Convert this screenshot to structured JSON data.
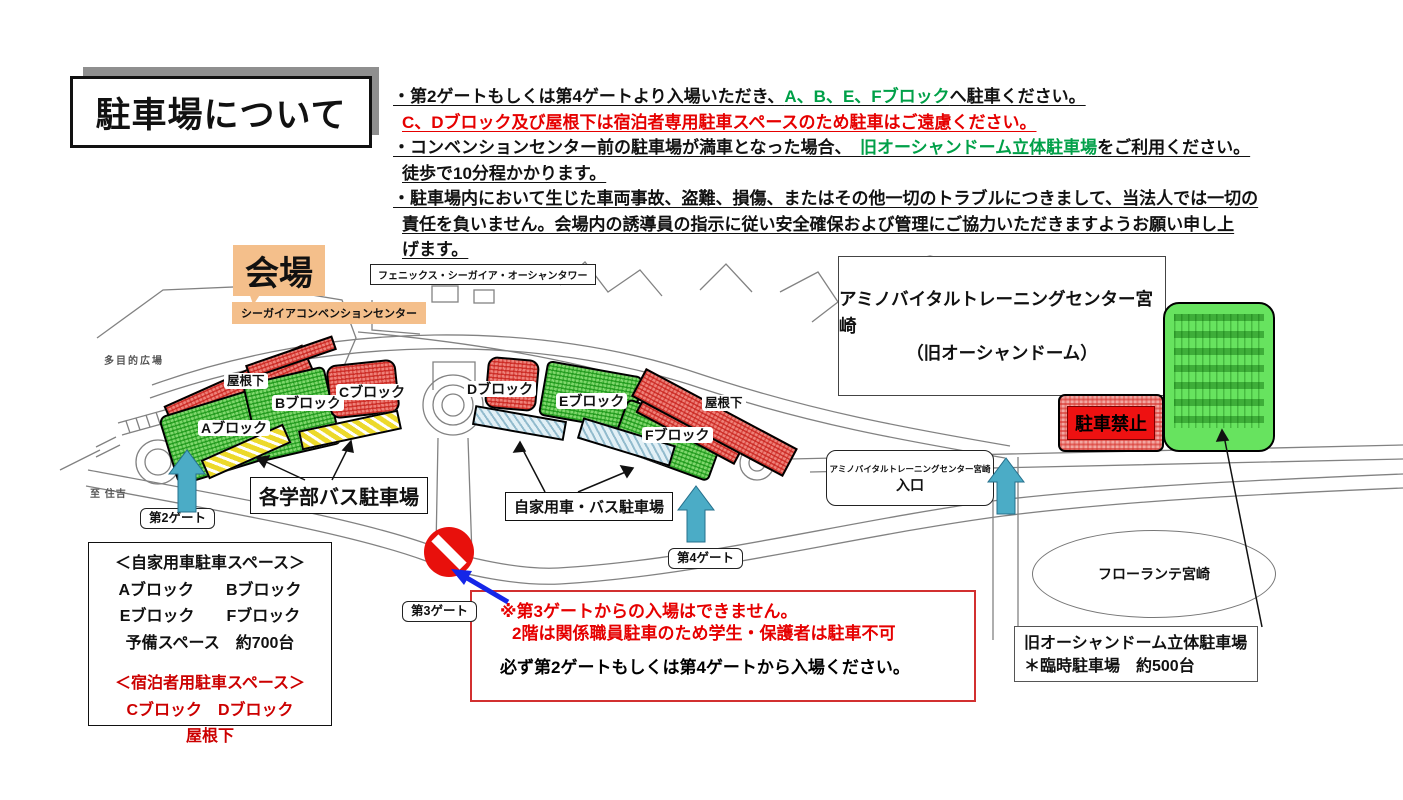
{
  "title": "駐車場について",
  "notes": {
    "l1a": "・第2ゲートもしくは第4ゲートより入場いただき、",
    "l1b": "A、B、E、Fブロック",
    "l1c": "へ駐車ください。",
    "l2": "C、Dブロック及び屋根下は宿泊者専用駐車スペースのため駐車はご遠慮ください。",
    "l3a": "・コンベンションセンター前の駐車場が満車となった場合、　",
    "l3b": "旧オーシャンドーム立体駐車場",
    "l3c": "をご利用ください。",
    "l4": "徒歩で10分程かかります。",
    "l5": "・駐車場内において生じた車両事故、盗難、損傷、またはその他一切のトラブルにつきまして、当法人では一切の",
    "l6": "責任を負いません。会場内の誘導員の指示に従い安全確保および管理にご協力いただきますようお願い申し上",
    "l7": "げます。"
  },
  "map": {
    "venue": "会場",
    "tower": "フェニックス・シーガイア・オーシャンタワー",
    "convention": "シーガイアコンベンションセンター",
    "plaza": "多目的広場",
    "sumiyoshi": "至 住吉",
    "blocks": {
      "a": "Aブロック",
      "b": "Bブロック",
      "c": "Cブロック",
      "d": "Dブロック",
      "e": "Eブロック",
      "f": "Fブロック"
    },
    "roof": "屋根下",
    "gate2": "第2ゲート",
    "gate3": "第3ゲート",
    "gate4": "第4ゲート",
    "bus_parking": "各学部バス駐車場",
    "private_parking": "自家用車・バス駐車場",
    "amino_center_l1": "アミノバイタルトレーニングセンター宮崎",
    "amino_center_l2": "（旧オーシャンドーム）",
    "amino_gate_l1": "アミノバイタルトレーニングセンター宮崎",
    "amino_gate_l2": "入口",
    "no_parking": "駐車禁止",
    "florante": "フローランテ宮崎",
    "dome_l1": "旧オーシャンドーム立体駐車場",
    "dome_l2": "＊臨時駐車場　約500台"
  },
  "legend": {
    "header": "＜自家用車駐車スペース＞",
    "row1": "Aブロック　　Bブロック",
    "row2": "Eブロック　　Fブロック",
    "row3": "予備スペース　約700台",
    "lodger_header": "＜宿泊者用駐車スペース＞",
    "lodger_row1": "Cブロック　Dブロック",
    "lodger_row2": "屋根下"
  },
  "warning": {
    "l1": "※第3ゲートからの入場はできません。",
    "l2": "2階は関係職員駐車のため学生・保護者は駐車不可",
    "l3": "必ず第2ゲートもしくは第4ゲートから入場ください。"
  },
  "colors": {
    "green_text": "#00a048",
    "red_text": "#e60000",
    "legend_red": "#cc0000",
    "orange_label": "#f4bf8b",
    "teal_arrow": "#4bacc6",
    "blue_arrow": "#1526e8",
    "block_red": "#ee8179",
    "block_green": "#7fd76c",
    "strip_yellow": "#ecd92b",
    "strip_blue": "#e2f0f6",
    "no_parking_red": "#ee1111"
  }
}
